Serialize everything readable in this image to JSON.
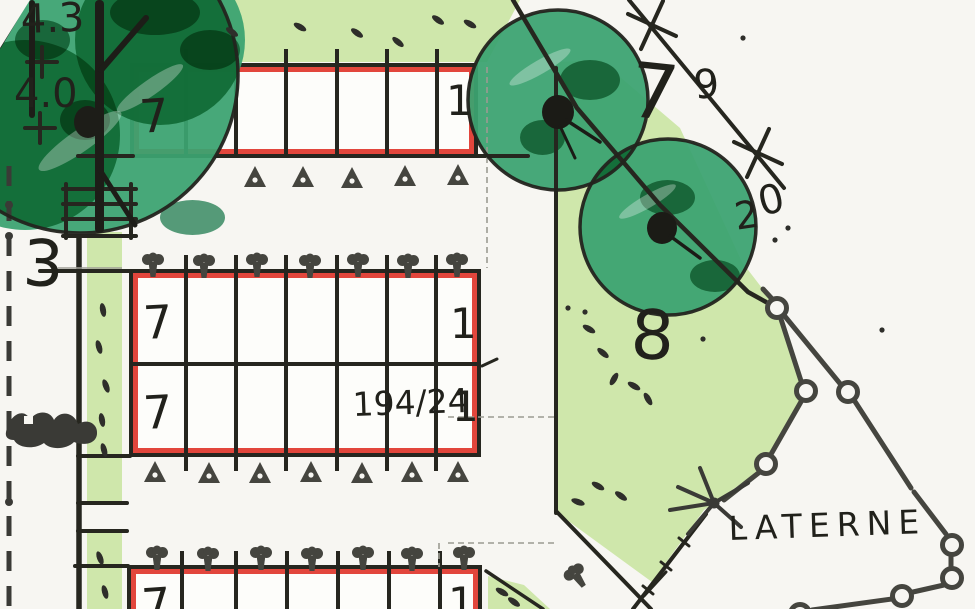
{
  "labels": {
    "spot_height_upper": "4.3",
    "spot_height_lower": "4.0",
    "margin_number": "3",
    "survey_7": "7",
    "survey_9": "9",
    "survey_2": "2",
    "survey_0": "0",
    "area_number": "8",
    "plot_number": "194/24",
    "lantern": "LATERNE"
  },
  "parking": {
    "top_row": {
      "first": "7",
      "last": "1"
    },
    "middle_row_upper": {
      "first": "7",
      "last": "1"
    },
    "middle_row_lower": {
      "first": "7",
      "last": "1"
    },
    "bottom_row": {
      "first": "7",
      "last": "1"
    }
  },
  "colors": {
    "paper": "#f7f6f2",
    "light_green": "#cfe7ab",
    "marker_green": "#3ba371",
    "outline_red": "#e2463c",
    "ink": "#26261f",
    "gray_ink": "#45453f"
  }
}
